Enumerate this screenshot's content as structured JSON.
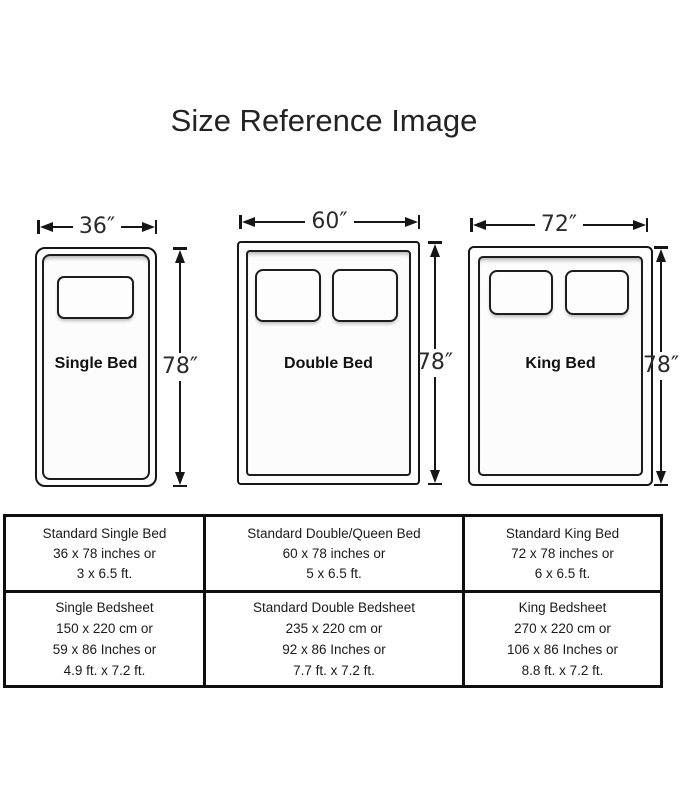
{
  "page": {
    "title": "Size Reference Image",
    "background_color": "#ffffff",
    "ink_color": "#161616"
  },
  "beds": [
    {
      "name": "Single Bed",
      "width_label": "36″",
      "height_label": "78″",
      "pillow_count": 1
    },
    {
      "name": "Double Bed",
      "width_label": "60″",
      "height_label": "78″",
      "pillow_count": 2
    },
    {
      "name": "King Bed",
      "width_label": "72″",
      "height_label": "78″",
      "pillow_count": 2
    }
  ],
  "table": {
    "rows": [
      {
        "cells": [
          {
            "lines": [
              "Standard Single Bed",
              "36 x 78 inches or",
              "3 x 6.5 ft."
            ]
          },
          {
            "lines": [
              "Standard Double/Queen Bed",
              "60 x 78 inches or",
              "5 x 6.5 ft."
            ]
          },
          {
            "lines": [
              "Standard King Bed",
              "72 x 78 inches or",
              "6 x 6.5 ft."
            ]
          }
        ]
      },
      {
        "cells": [
          {
            "lines": [
              "Single Bedsheet",
              "150 x 220 cm or",
              "59 x 86 Inches or",
              "4.9 ft. x 7.2 ft."
            ]
          },
          {
            "lines": [
              "Standard Double Bedsheet",
              "235 x 220 cm or",
              "92 x 86 Inches or",
              "7.7 ft. x 7.2 ft."
            ]
          },
          {
            "lines": [
              "King Bedsheet",
              "270 x 220 cm or",
              "106 x 86 Inches or",
              "8.8 ft. x 7.2 ft."
            ]
          }
        ]
      }
    ]
  }
}
